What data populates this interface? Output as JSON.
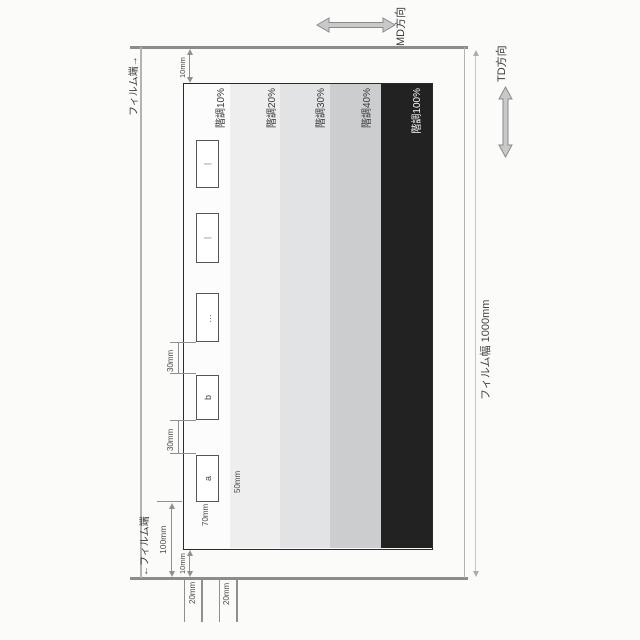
{
  "diagram": {
    "directions": {
      "md_label": "MD方向",
      "td_label": "TD方向"
    },
    "film": {
      "edge_label_right": "フィルム端→",
      "edge_label_left": "←フィルム端",
      "width_label": "フィルム幅 1000mm"
    },
    "gradation": {
      "labels": [
        "階調10%",
        "階調20%",
        "階調30%",
        "階調40%",
        "階調100%"
      ],
      "stripe_colors": [
        "#eeeeef",
        "#e2e3e4",
        "#cccdcf",
        "#222222"
      ],
      "label_color_dark": "#3a3a3a",
      "label_color_light": "#f5f5f5"
    },
    "marks": {
      "a": "a",
      "b": "b",
      "dots": "…",
      "bar1": "|",
      "bar2": "|"
    },
    "dimensions": {
      "d100": "100mm",
      "d70": "70mm",
      "d50": "50mm",
      "d30_ab": "30mm",
      "d30_bdots": "30mm",
      "d10_left": "10mm",
      "d10_right": "10mm",
      "d20_first": "20mm",
      "d20_second": "20mm"
    }
  }
}
